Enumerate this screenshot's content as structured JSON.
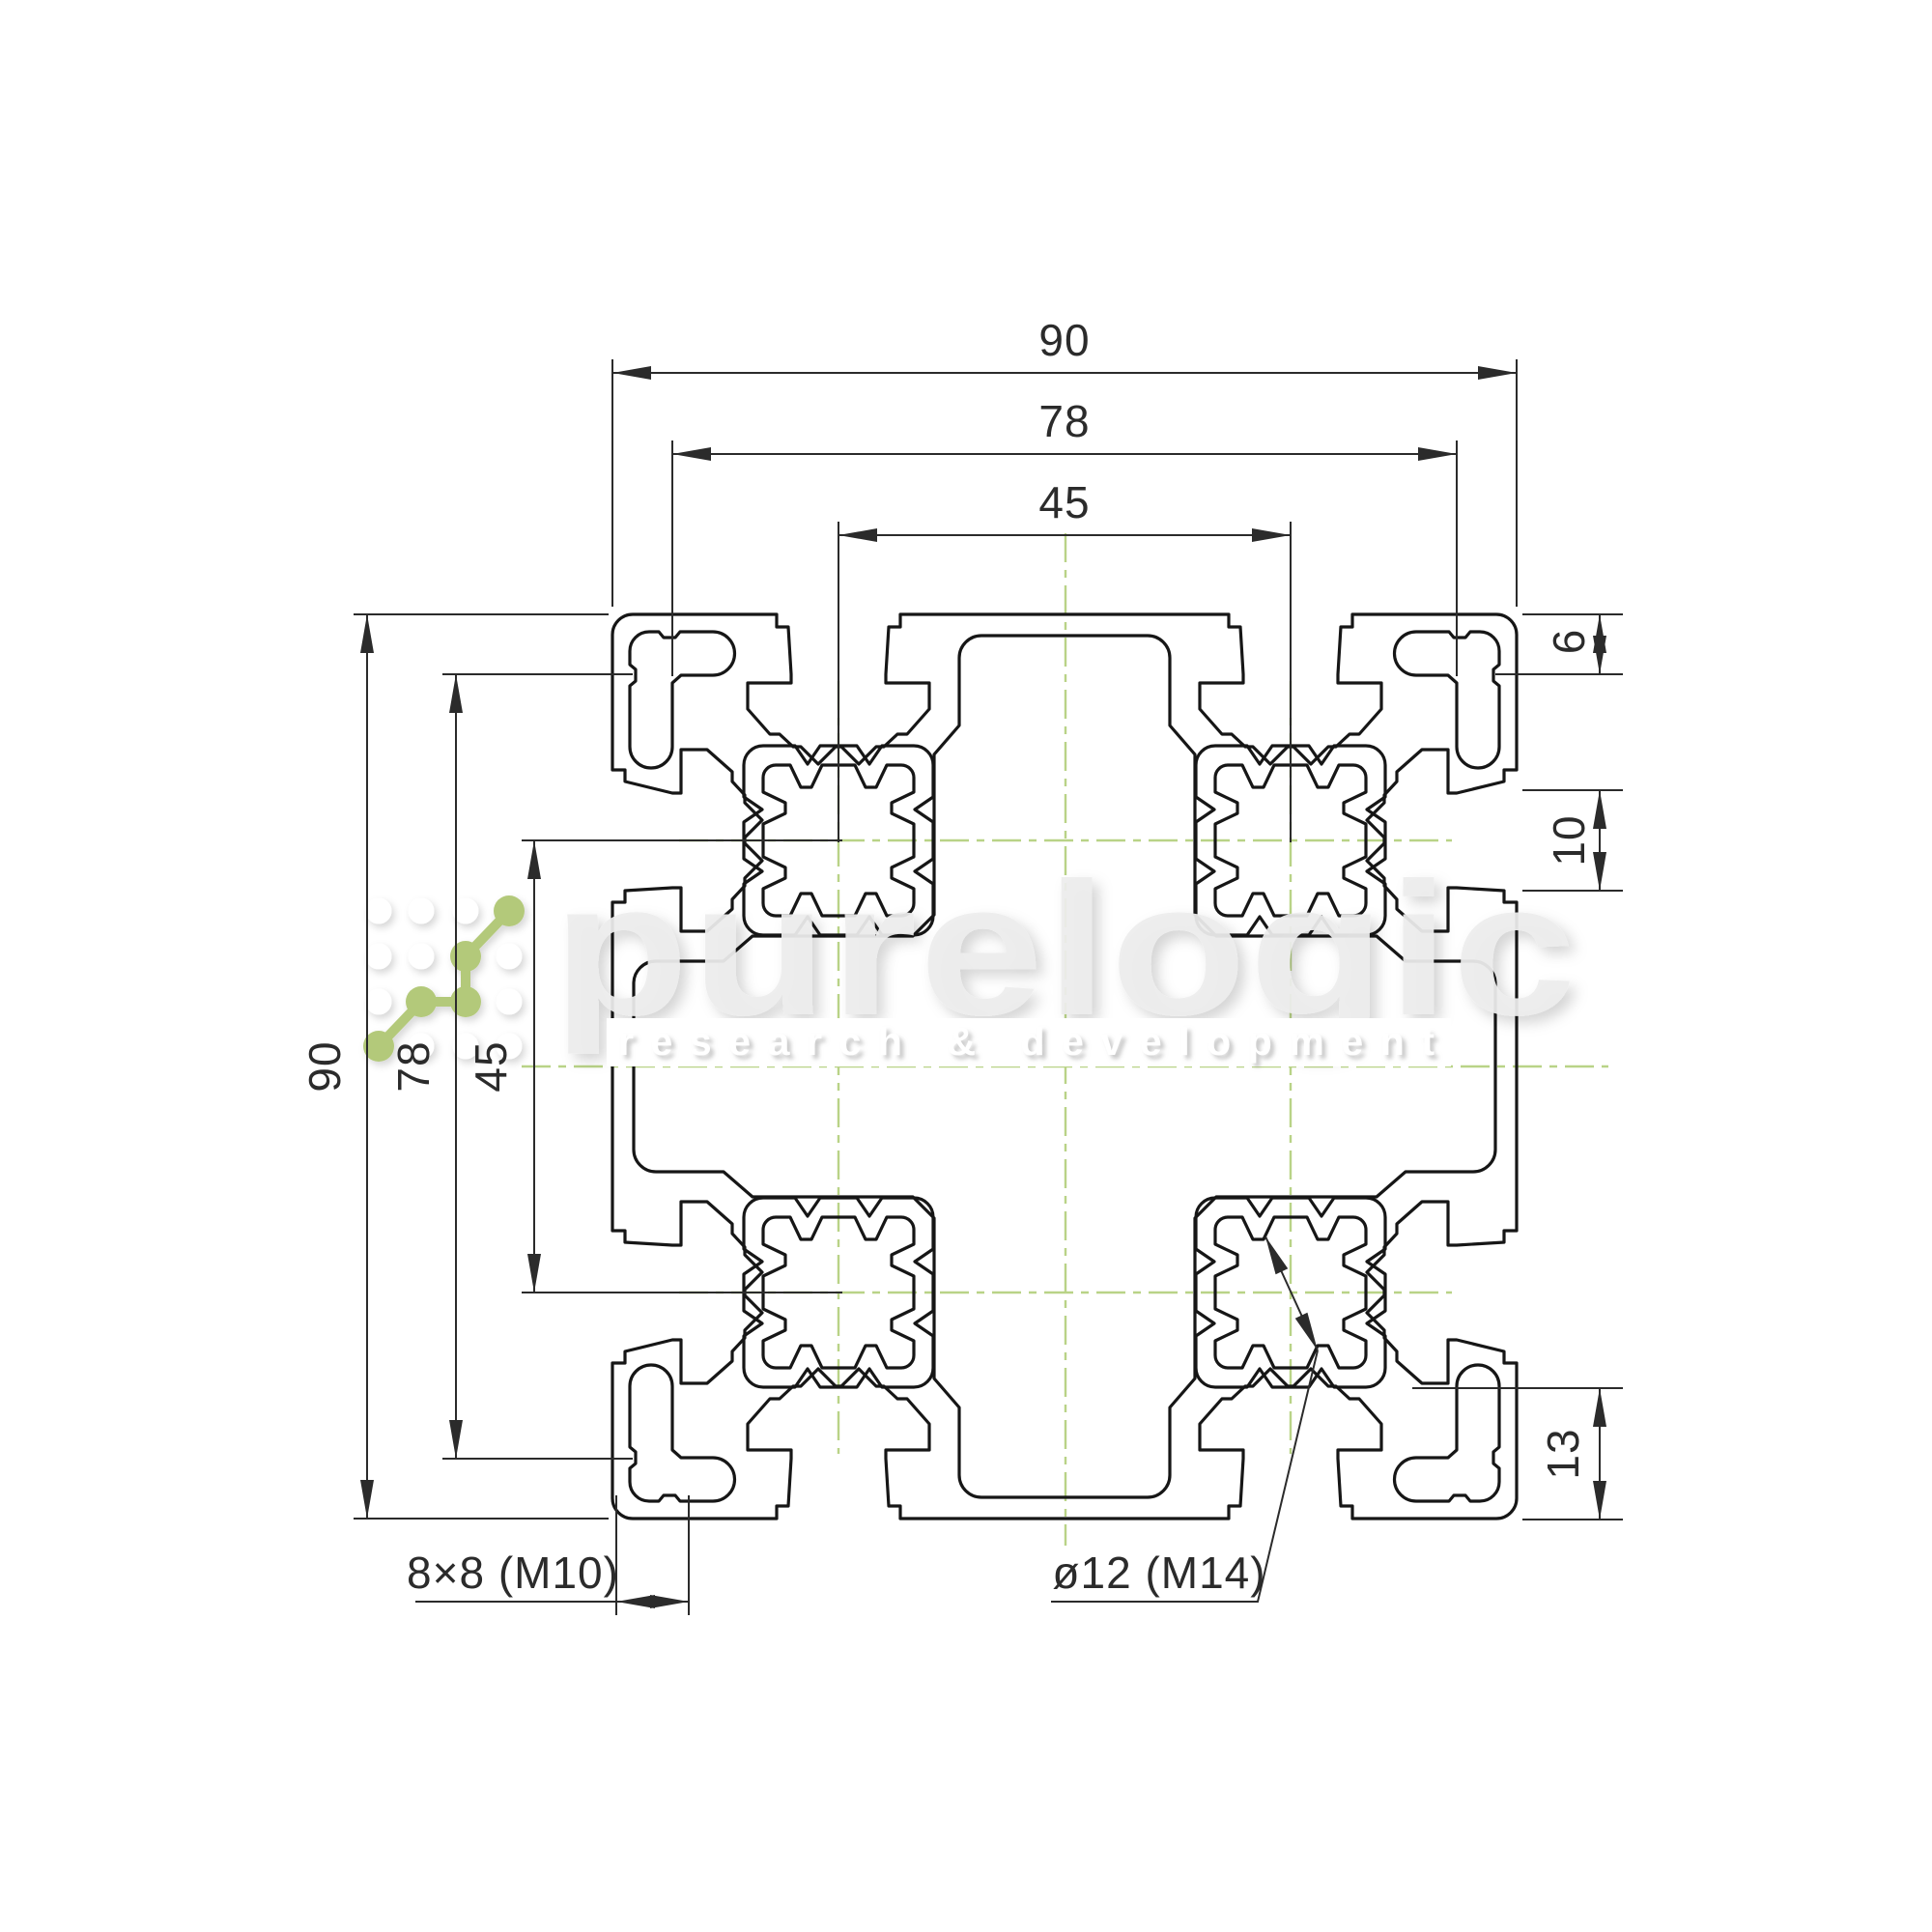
{
  "drawing": {
    "title": "aluminium-extrusion-profile-90x90-cross-section",
    "dims": {
      "top_90": "90",
      "top_78": "78",
      "top_45": "45",
      "left_90": "90",
      "left_78": "78",
      "left_45": "45",
      "right_6": "6",
      "right_10": "10",
      "right_13": "13"
    },
    "callouts": {
      "corner_slot": "8×8 (M10)",
      "screw_bore": "ø12 (M14)"
    },
    "watermark": {
      "brand": "purelogic",
      "tagline": "research & development"
    },
    "colors": {
      "profile_line": "#161616",
      "dim_line": "#2b2b2b",
      "centerline_green": "#b9d387",
      "logo_green": "#b3c97a",
      "watermark_gray": "#ededed"
    }
  }
}
